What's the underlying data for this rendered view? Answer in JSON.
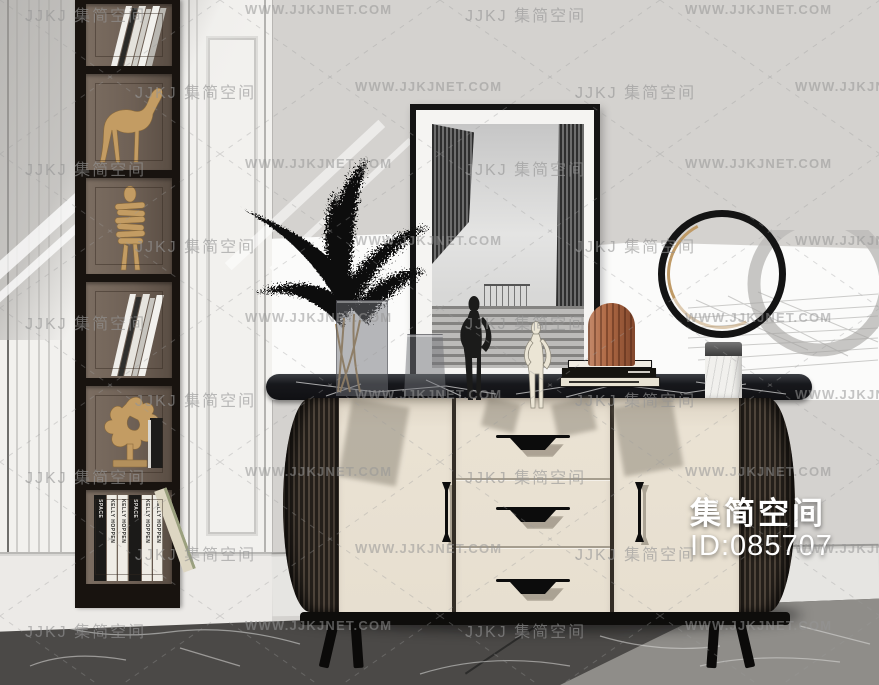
{
  "watermark": {
    "brand": "JJKJ 集简空间",
    "url": "WWW.JJKJNET.COM"
  },
  "overlay": {
    "brand": "集简空间",
    "model_id": "ID:085707"
  },
  "bookshelf": {
    "book_row": [
      {
        "label": "SPACE",
        "style": "black"
      },
      {
        "label": "KELLY HOPPEN",
        "style": "white"
      },
      {
        "label": "KELLY HOPPEN",
        "style": "white"
      },
      {
        "label": "SPACE",
        "style": "black"
      },
      {
        "label": "KELLY HOPPEN",
        "style": "white"
      },
      {
        "label": "KELLY HOPPEN",
        "style": "white"
      },
      {
        "label": "",
        "style": "lean"
      }
    ]
  },
  "colors": {
    "wall_gray": "#d4d2cf",
    "wall_white": "#f2f1ee",
    "cabinet_cream": "#e7dfd0",
    "marble_black": "#17181c",
    "fluted_wood": "#241f1a",
    "gold_accent": "#c39c63",
    "terracotta": "#b06a45",
    "floor_dark": "#4b4947",
    "overlay_text": "#ffffff",
    "watermark_gray": "#949494"
  }
}
